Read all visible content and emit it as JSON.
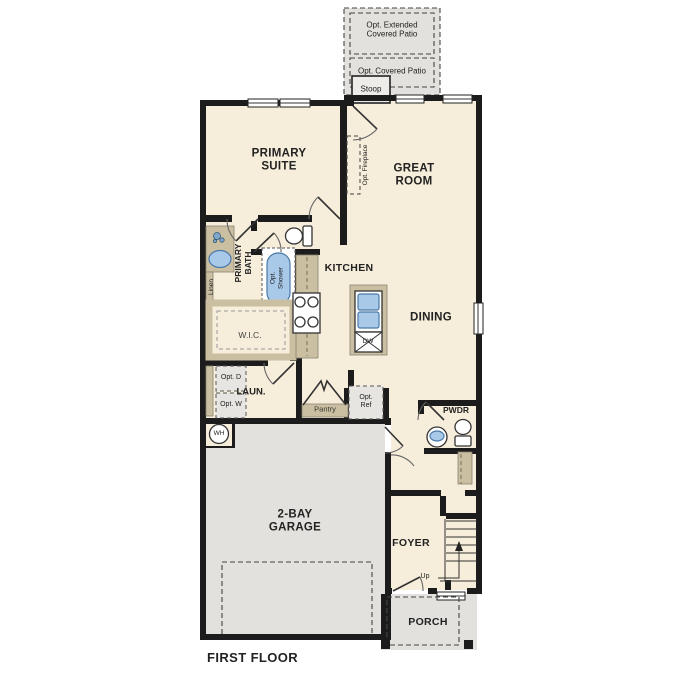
{
  "page": {
    "title": "FIRST FLOOR"
  },
  "colors": {
    "floor": "#f6edda",
    "concrete": "#e2e1dd",
    "wall": "#1c1c1c",
    "wood": "#cbbfa2",
    "blue": "#a9c9e9",
    "blue_border": "#4a7aa8",
    "appliance": "#e7e5e1",
    "ink": "#222222"
  },
  "labels": {
    "opt_extended_patio": "Opt. Extended Covered Patio",
    "opt_covered_patio": "Opt. Covered Patio",
    "stoop": "Stoop",
    "primary_suite": "PRIMARY SUITE",
    "great_room": "GREAT ROOM",
    "opt_fireplace": "Opt. Fireplace",
    "primary_bath": "PRIMARY BATH",
    "linen": "Linen",
    "opt_shower": "Opt. Shower",
    "wic": "W.I.C.",
    "kitchen": "KITCHEN",
    "dining": "DINING",
    "dw": "DW",
    "laundry": "LAUN.",
    "opt_dryer": "Opt. D",
    "opt_washer": "Opt. W",
    "pantry": "Pantry",
    "opt_ref": "Opt. Ref",
    "water_heater": "WH",
    "garage": "2-BAY GARAGE",
    "powder": "PWDR",
    "foyer": "FOYER",
    "up": "Up",
    "porch": "PORCH",
    "first_floor": "FIRST FLOOR"
  }
}
